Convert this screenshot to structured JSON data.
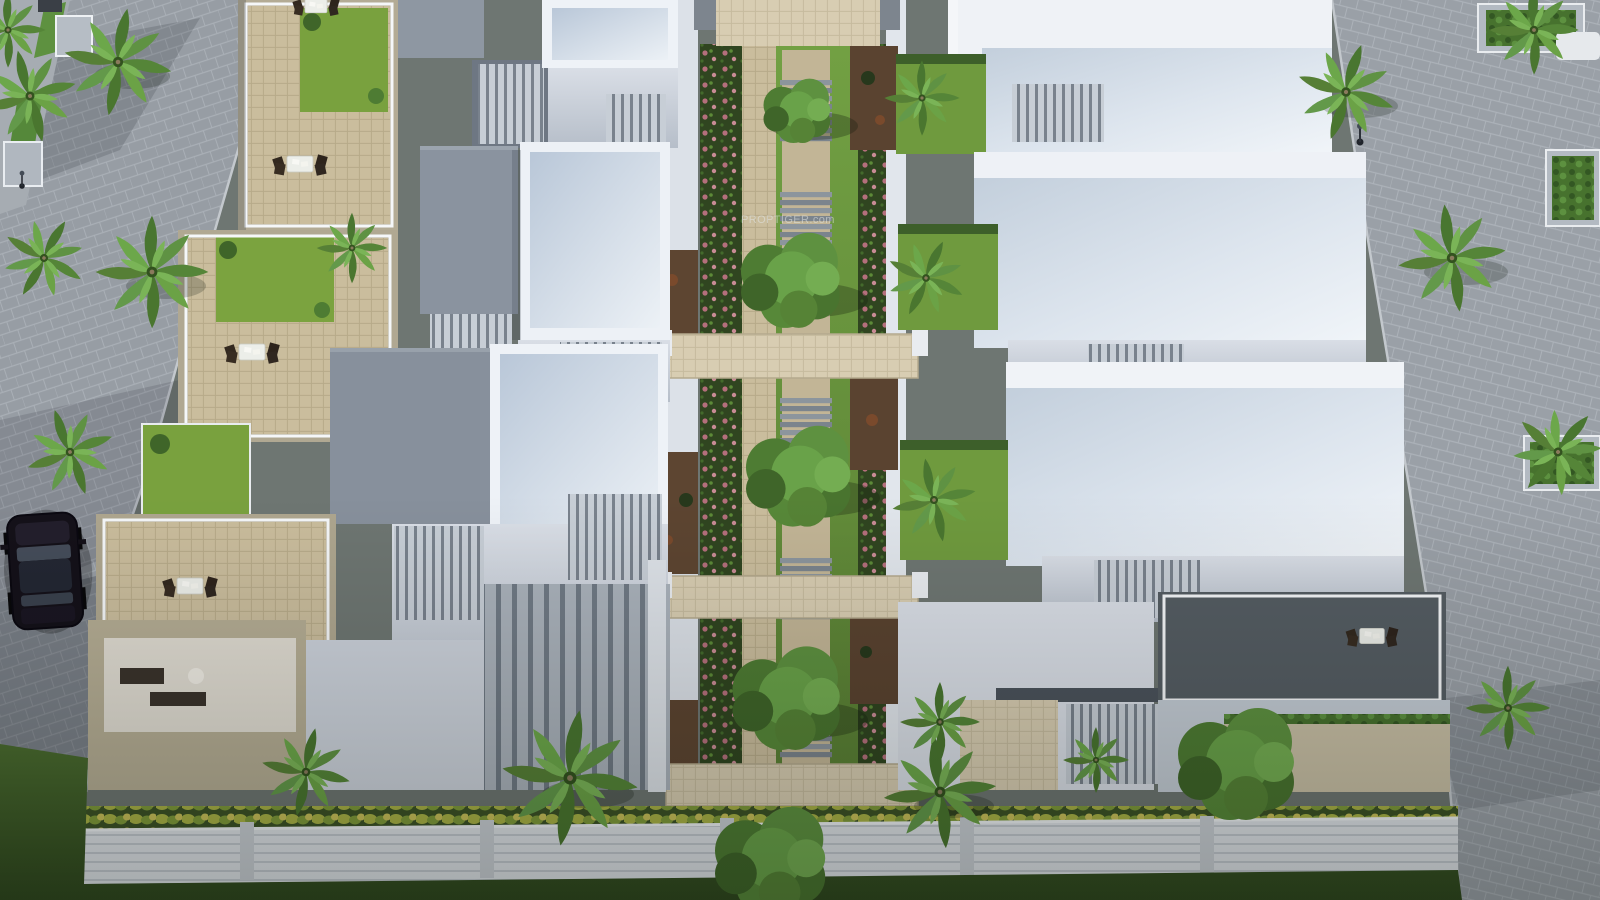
{
  "watermark": {
    "text": "PROPTIGER.com"
  },
  "scene": {
    "kind": "aerial-3d-architectural-render",
    "subject": "row-villa residential community with central landscaped walkway",
    "visible_counts": {
      "villa_rows": 2,
      "villas_per_row": 4,
      "parked_cars": 1,
      "patio_furniture_sets": 5
    }
  },
  "palette": {
    "road_paving": "#979da4",
    "walkway_tile": "#cabd9d",
    "villa_white": "#eef2f7",
    "roof_slope_blue": "#b9c7d8",
    "roof_gray": "#8a939f",
    "louver_gray": "#79828d",
    "terrace_lawn": "#79a13e",
    "garden_lawn": "#6f9a40",
    "perimeter_grass": "#44652c",
    "flower_pink": "#b46f7c",
    "shrub_yellow": "#a9b246",
    "palm_green": "#5e9140",
    "deck_wood": "#5d4531",
    "car_body": "#141119",
    "railing_white": "#f5f7f9",
    "boundary_wall": "#dee2e7"
  }
}
